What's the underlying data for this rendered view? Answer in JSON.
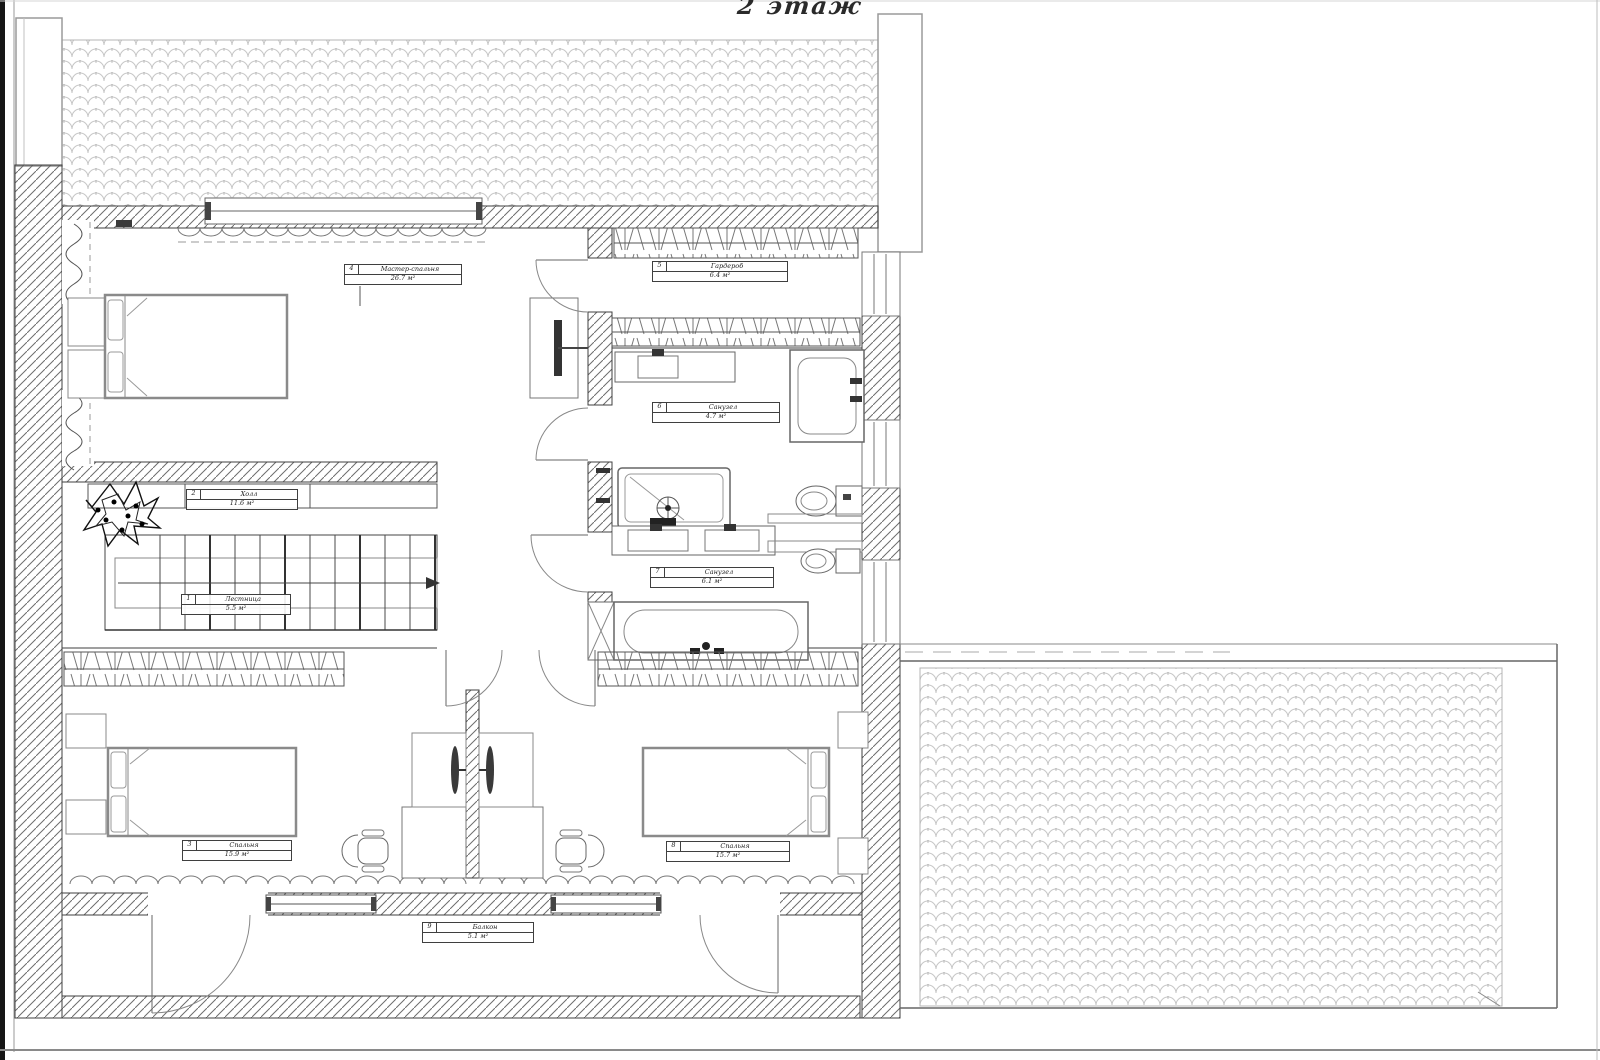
{
  "title": "2 этаж",
  "colors": {
    "ink": "#3f3f3f",
    "hatch_line": "#6d6d6d",
    "roof_tile_line": "#c6c6c6",
    "furniture_line": "#8a8a8a",
    "paper": "#ffffff"
  },
  "rooms": [
    {
      "num": "1",
      "name": "Лестница",
      "area": "5.5 м²"
    },
    {
      "num": "2",
      "name": "Холл",
      "area": "11.6 м²"
    },
    {
      "num": "3",
      "name": "Спальня",
      "area": "15.9 м²"
    },
    {
      "num": "4",
      "name": "Мастер-спальня",
      "area": "26.7 м²"
    },
    {
      "num": "5",
      "name": "Гардероб",
      "area": "6.4 м²"
    },
    {
      "num": "6",
      "name": "Санузел",
      "area": "4.7 м²"
    },
    {
      "num": "7",
      "name": "Санузел",
      "area": "6.1 м²"
    },
    {
      "num": "8",
      "name": "Спальня",
      "area": "15.7 м²"
    },
    {
      "num": "9",
      "name": "Балкон",
      "area": "5.1 м²"
    }
  ]
}
